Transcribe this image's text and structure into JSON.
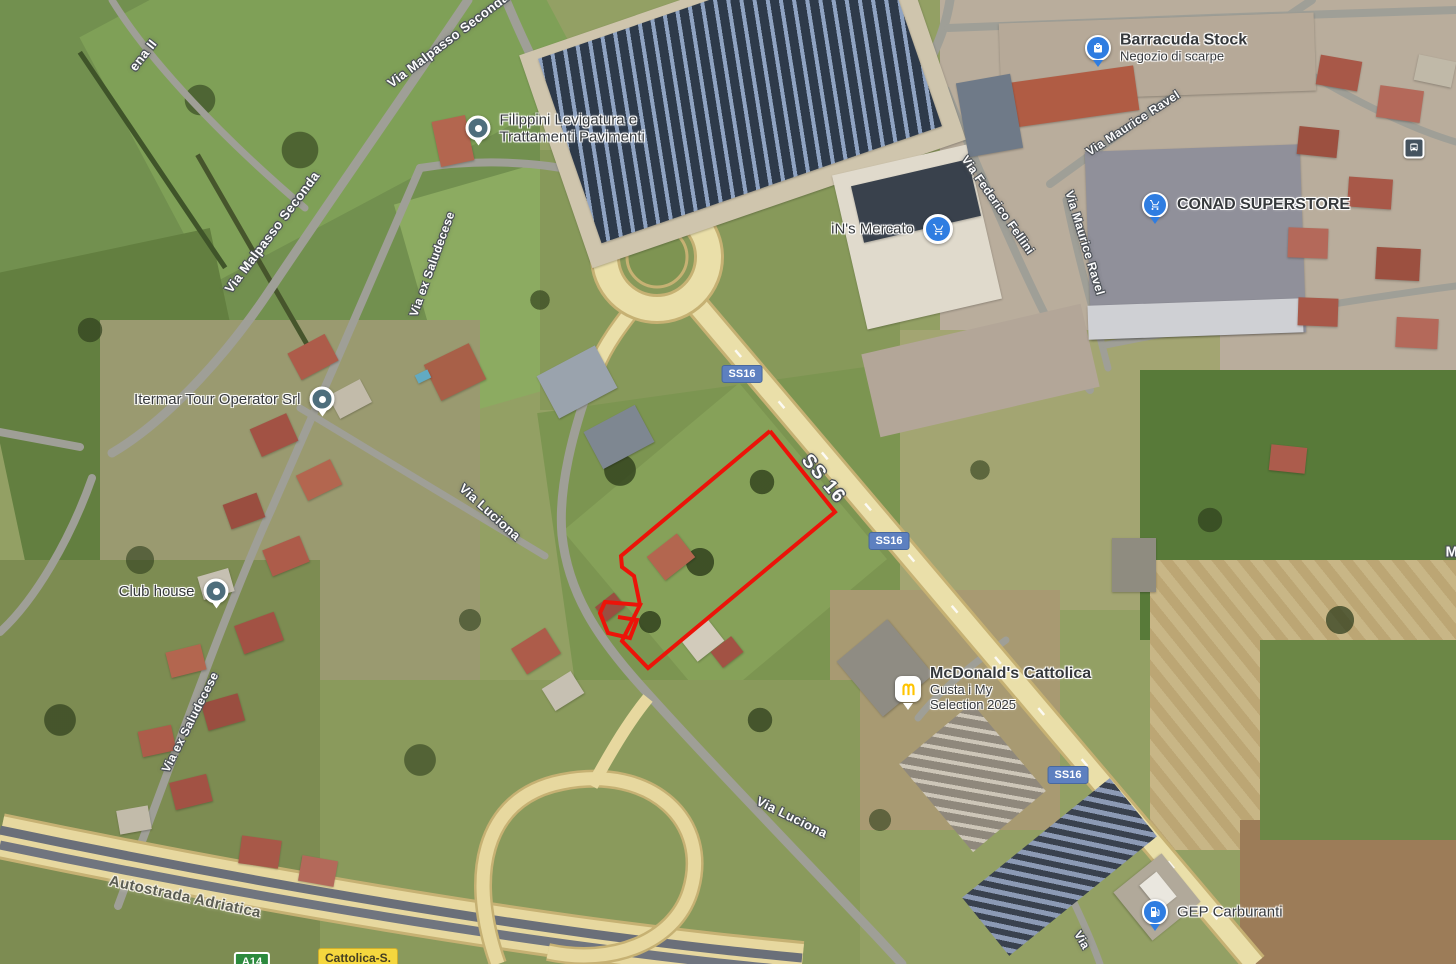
{
  "road_labels": [
    {
      "text": "ena II"
    },
    {
      "text": "Via Malpasso Seconda"
    },
    {
      "text": "Via Malpasso Seconda"
    },
    {
      "text": "Via ex Saludecese"
    },
    {
      "text": "Via ex Saludecese"
    },
    {
      "text": "Via Luciona"
    },
    {
      "text": "Via Luciona"
    },
    {
      "text": "SS 16"
    },
    {
      "text": "Autostrada Adriatica"
    },
    {
      "text": "Via Federico Fellini"
    },
    {
      "text": "Via Maurice Ravel"
    },
    {
      "text": "Via Maurice Ravel"
    },
    {
      "text": "Via"
    },
    {
      "text": "M"
    }
  ],
  "route_badges": [
    {
      "text": "SS16",
      "style": "blue"
    },
    {
      "text": "SS16",
      "style": "blue"
    },
    {
      "text": "SS16",
      "style": "blue"
    },
    {
      "text": "A14",
      "style": "green"
    },
    {
      "text": "Cattolica-S.",
      "style": "yellow"
    }
  ],
  "pois": [
    {
      "name": "Filippini Levigatura e",
      "name2": "Trattamenti Pavimenti",
      "icon": "place-pin"
    },
    {
      "name": "Itermar Tour Operator Srl",
      "icon": "place-pin"
    },
    {
      "name": "Club house",
      "icon": "place-pin"
    },
    {
      "name": "Barracuda Stock",
      "name2": "Negozio di scarpe",
      "icon": "shopping-bag-pin"
    },
    {
      "name": "iN's Mercato",
      "icon": "shopping-cart-badge"
    },
    {
      "name": "CONAD SUPERSTORE",
      "icon": "shopping-cart-pin"
    },
    {
      "name": "McDonald's Cattolica",
      "name2": "Gusta i My",
      "name3": "Selection 2025",
      "icon": "mcdonalds-logo"
    },
    {
      "name": "GEP Carburanti",
      "icon": "fuel-pin"
    },
    {
      "name": "Bus stop",
      "icon": "bus-stop"
    }
  ],
  "colors": {
    "parcel_outline": "#ec1309",
    "route_badge_blue": "#5d80c0",
    "motorway_badge_green": "#2d8a3e",
    "exit_badge_yellow": "#f5d73e",
    "poi_pin_blue": "#2f7de1",
    "poi_pin_teal": "#4e6e7c",
    "major_road_fill": "#eadfa9",
    "minor_road_fill": "#9f9f97"
  }
}
